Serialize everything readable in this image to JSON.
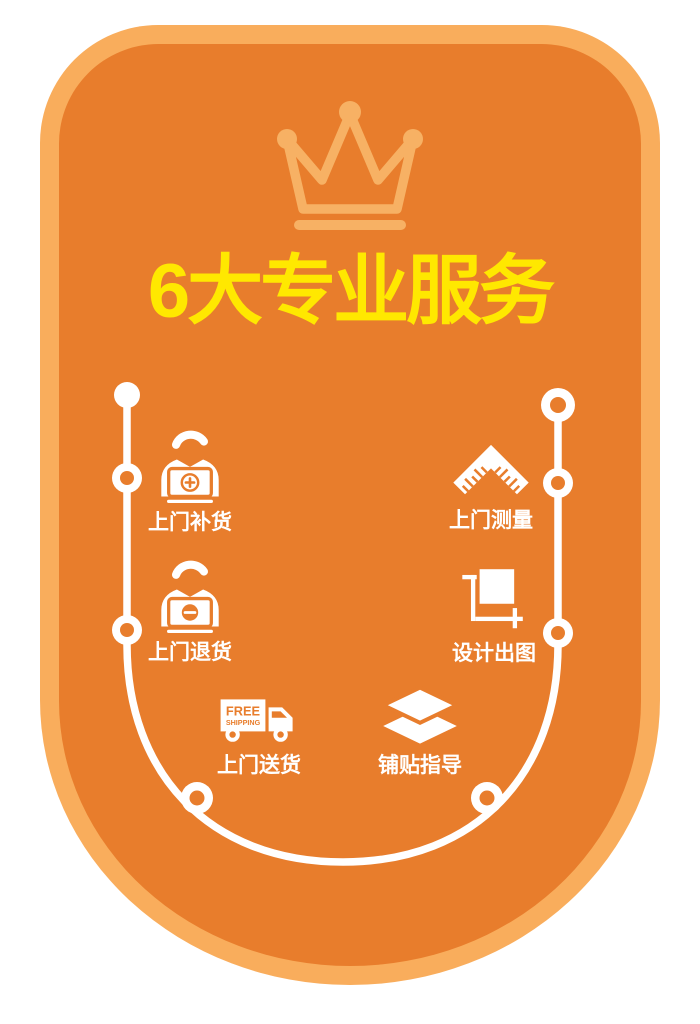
{
  "title": {
    "text": "6大专业服务",
    "color": "#FFE800"
  },
  "badge": {
    "fill": "#E87D2C",
    "border": "#F9AD5C",
    "crown_color": "#F7B164"
  },
  "services": [
    {
      "label": "上门补货",
      "icon": "restock-person-icon"
    },
    {
      "label": "上门测量",
      "icon": "measure-ruler-icon"
    },
    {
      "label": "上门退货",
      "icon": "return-person-icon"
    },
    {
      "label": "设计出图",
      "icon": "design-drawing-icon"
    },
    {
      "label": "上门送货",
      "icon": "delivery-truck-icon"
    },
    {
      "label": "铺贴指导",
      "icon": "tiling-guide-icon"
    }
  ],
  "truck": {
    "line1": "FREE",
    "line2": "SHIPPING"
  }
}
